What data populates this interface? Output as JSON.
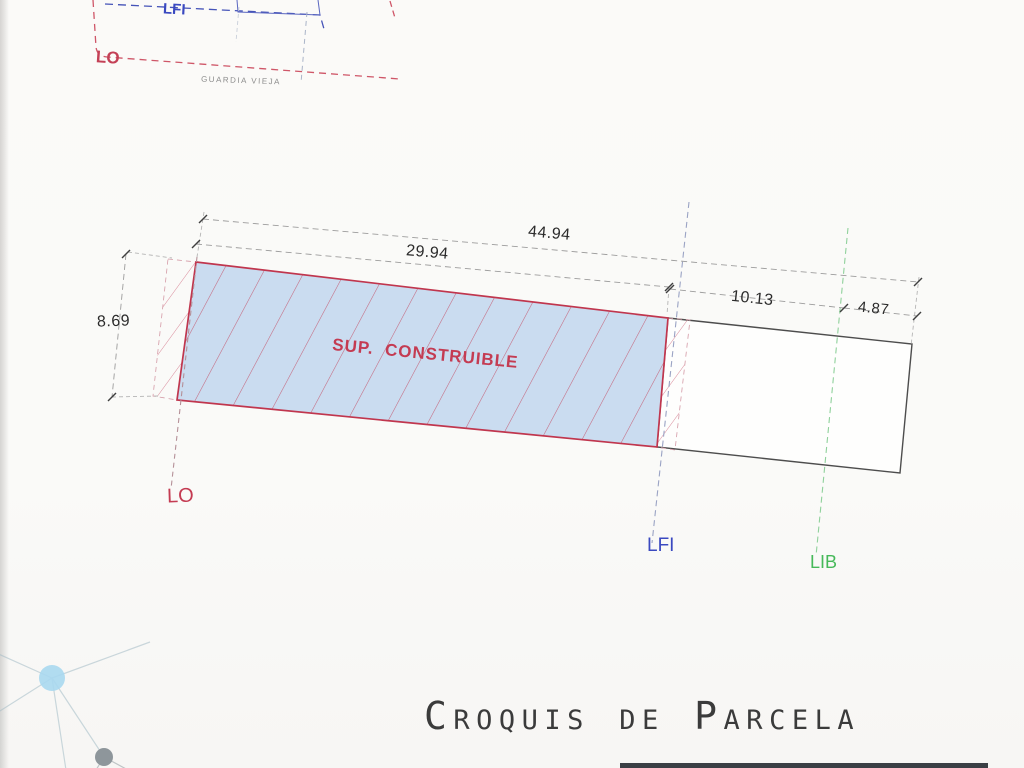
{
  "colors": {
    "red_accent": "#c43b52",
    "blue_accent": "#3a49c0",
    "green_accent": "#46b959",
    "parcel_fill": "#cadcf0",
    "outline_dark": "#4d4d4d",
    "dimension_text": "#2b2b2b",
    "title_text": "#3b3b3b"
  },
  "minimap": {
    "lfi_label": "LFI",
    "lo_label": "LO",
    "street_name": "GUARDIA VIEJA"
  },
  "parcel": {
    "area_label": "SUP.  CONSTRUIBLE",
    "dimensions": {
      "total_width": "44.94",
      "buildable_width": "29.94",
      "buildable_depth": "8.69",
      "rear_width": "10.13",
      "edge_width": "4.87"
    },
    "reference_lines": [
      {
        "id": "lo",
        "label": "LO"
      },
      {
        "id": "lfi",
        "label": "LFI"
      },
      {
        "id": "lib",
        "label": "LIB"
      }
    ]
  },
  "title": "Croquis de Parcela"
}
